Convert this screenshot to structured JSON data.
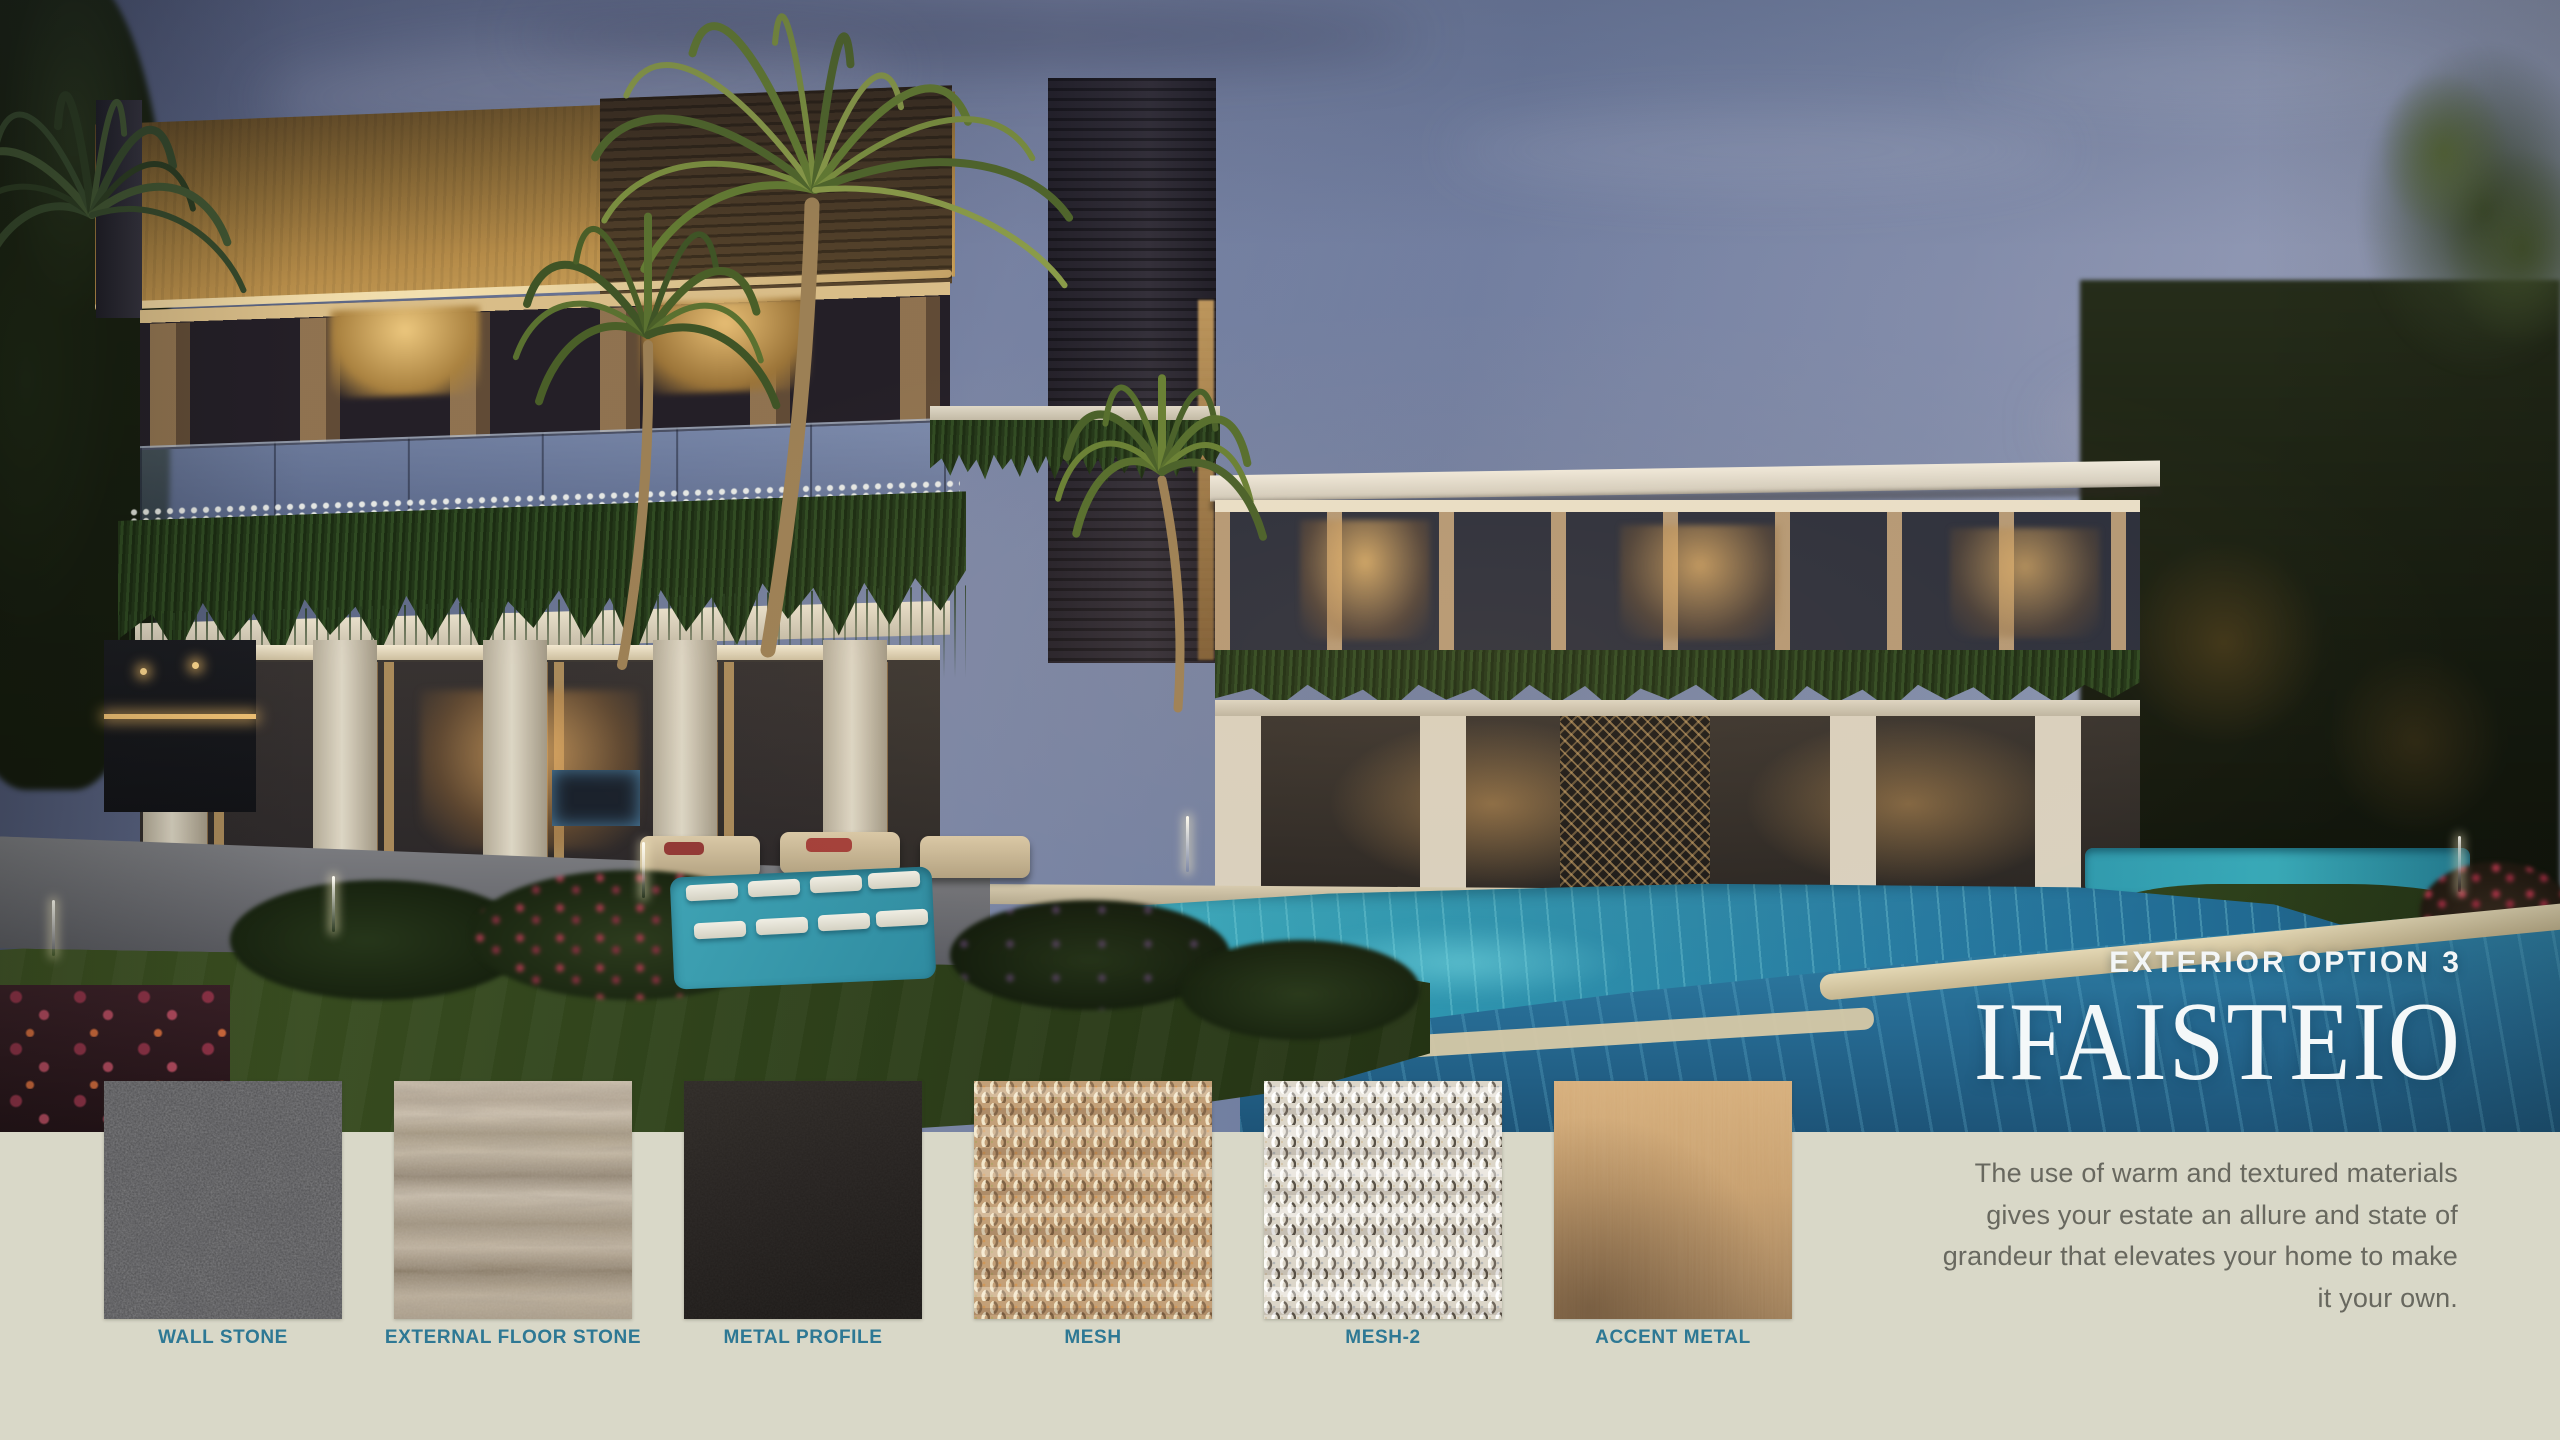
{
  "hero": {
    "option_label": "EXTERIOR OPTION 3",
    "option_name": "IFAISTEIO"
  },
  "description": {
    "lines": [
      "The use of warm and textured materials",
      "gives your estate an allure and state of",
      "grandeur that elevates your home to make",
      "it your own."
    ]
  },
  "materials": {
    "items": [
      {
        "label": "WALL STONE",
        "texture": "dark-speckled-granite"
      },
      {
        "label": "EXTERNAL FLOOR STONE",
        "texture": "beige-banded-travertine"
      },
      {
        "label": "METAL PROFILE",
        "texture": "dark-charcoal-metal"
      },
      {
        "label": "MESH",
        "texture": "bronze-woven-metal-mesh"
      },
      {
        "label": "MESH-2",
        "texture": "silver-woven-metal-mesh"
      },
      {
        "label": "ACCENT METAL",
        "texture": "brushed-bronze"
      }
    ]
  },
  "photo": {
    "alt": "Twilight rendering of a modern two-storey luxury villa with bronze slatted volumes, white stone columns, cascading greenery, palm trees, lawns and a glowing turquoise swimming pool"
  },
  "colors": {
    "page_background": "#d9d8c8",
    "label_teal": "#2e7894",
    "paragraph_gray": "#68685f",
    "title_white": "#f4f8f9",
    "pool_teal": "#2f97b0",
    "building_bronze": "#b68c49"
  }
}
